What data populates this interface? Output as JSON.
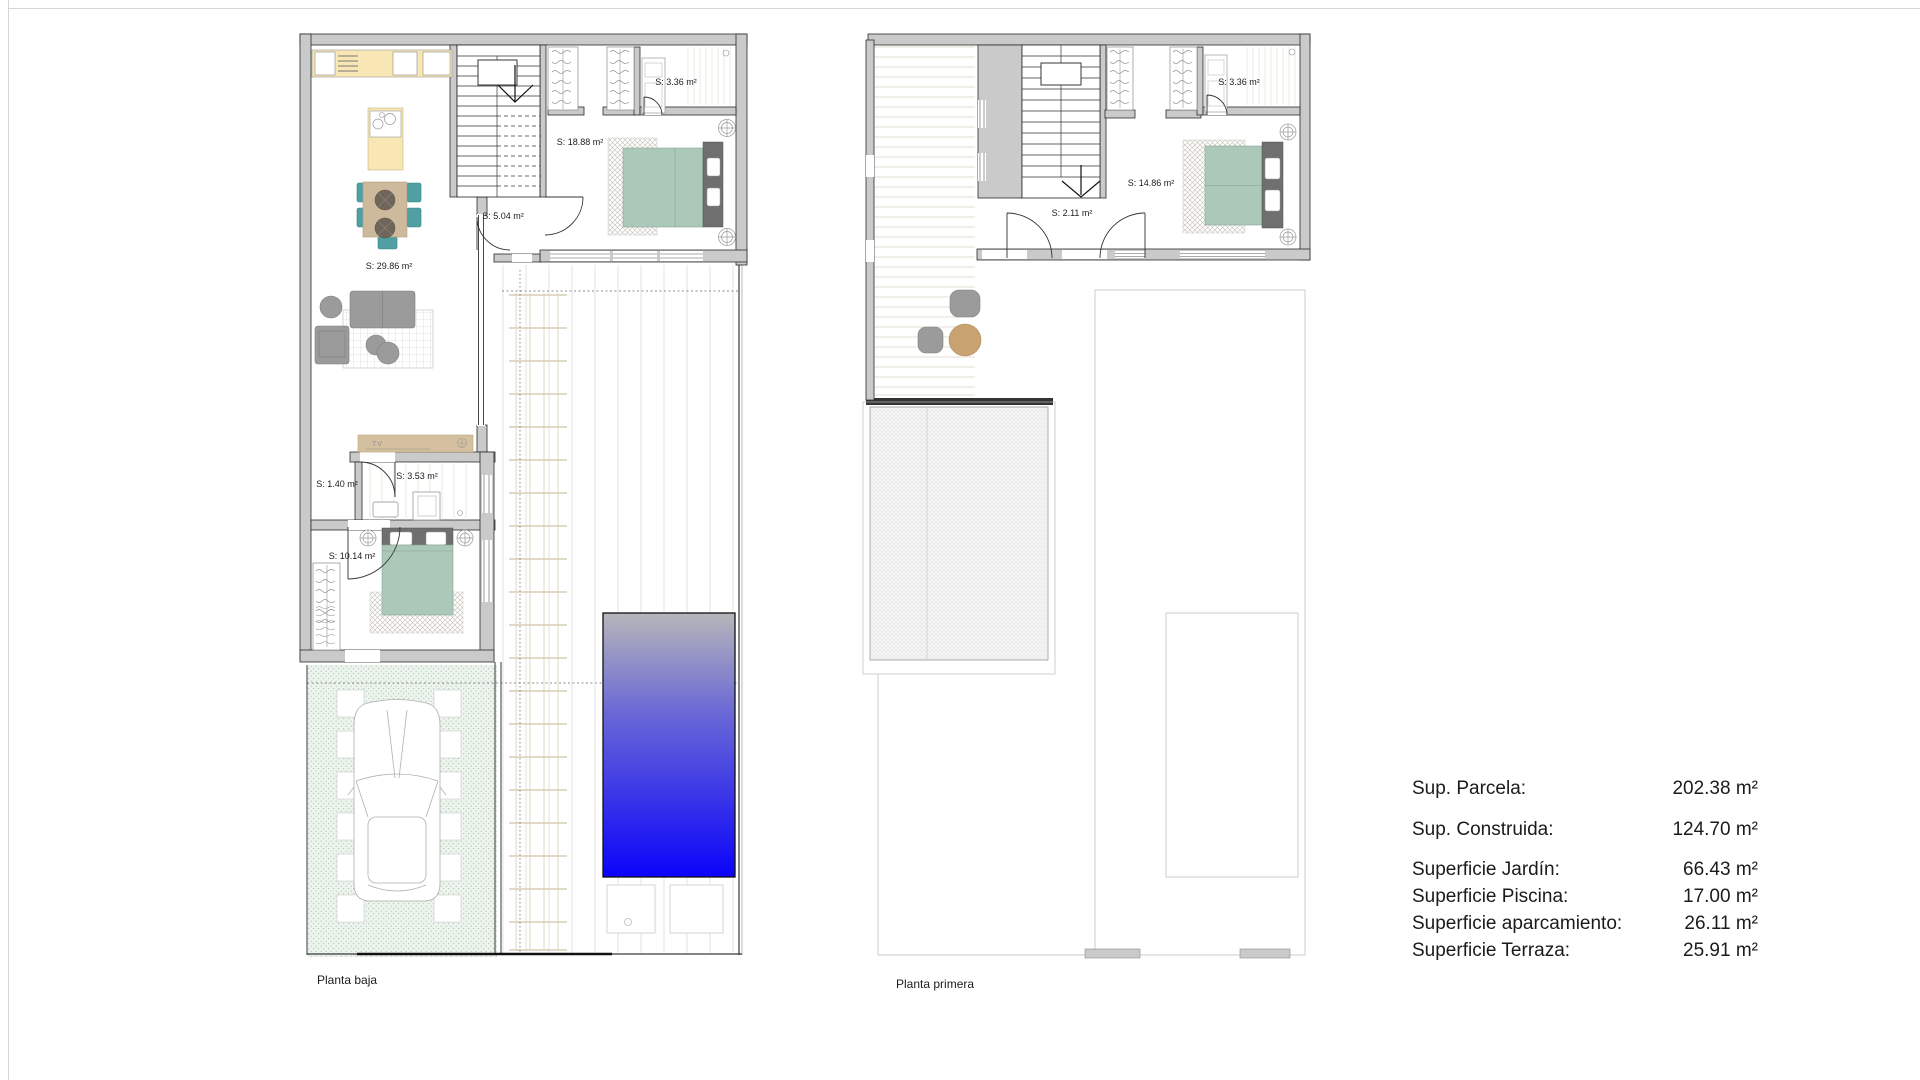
{
  "ground_floor": {
    "title": "Planta baja",
    "rooms": {
      "living_kitchen": "S: 29.86 m²",
      "master_bedroom": "S: 18.88 m²",
      "master_bathroom": "S: 3.36 m²",
      "hallway": "S: 5.04 m²",
      "corridor": "S: 1.40 m²",
      "bathroom": "S: 3.53 m²",
      "bedroom2": "S: 10.14 m²"
    },
    "tv_label": "TV"
  },
  "first_floor": {
    "title": "Planta primera",
    "rooms": {
      "bathroom": "S: 3.36 m²",
      "bedroom": "S: 14.86 m²",
      "hallway": "S: 2.11 m²"
    }
  },
  "legend": {
    "rows": [
      {
        "label": "Sup. Parcela:",
        "value": "202.38 m²"
      },
      {
        "label": "Sup. Construida:",
        "value": "124.70 m²"
      },
      {
        "label": "Superficie Jardín:",
        "value": "66.43 m²"
      },
      {
        "label": "Superficie Piscina:",
        "value": "17.00 m²"
      },
      {
        "label": "Superficie aparcamiento:",
        "value": "26.11 m²"
      },
      {
        "label": "Superficie Terraza:",
        "value": "25.91 m²"
      }
    ]
  },
  "colors": {
    "wall": "#cacaca",
    "pool_top": "#b6b6ba",
    "pool_mid": "#6a68d6",
    "pool_bottom": "#0b04fa",
    "bed_green": "#abc8b9",
    "headboard_gray": "#6f6f6f",
    "chair_teal": "#4f9fa3",
    "table_wood": "#cdb99c",
    "kitchen_counter": "#f8e7b4",
    "tv_cabinet": "#d4c09e",
    "sofa_gray": "#9b9b9b",
    "garden_dot": "#a9c9ae",
    "terrace_table": "#c9a272"
  }
}
